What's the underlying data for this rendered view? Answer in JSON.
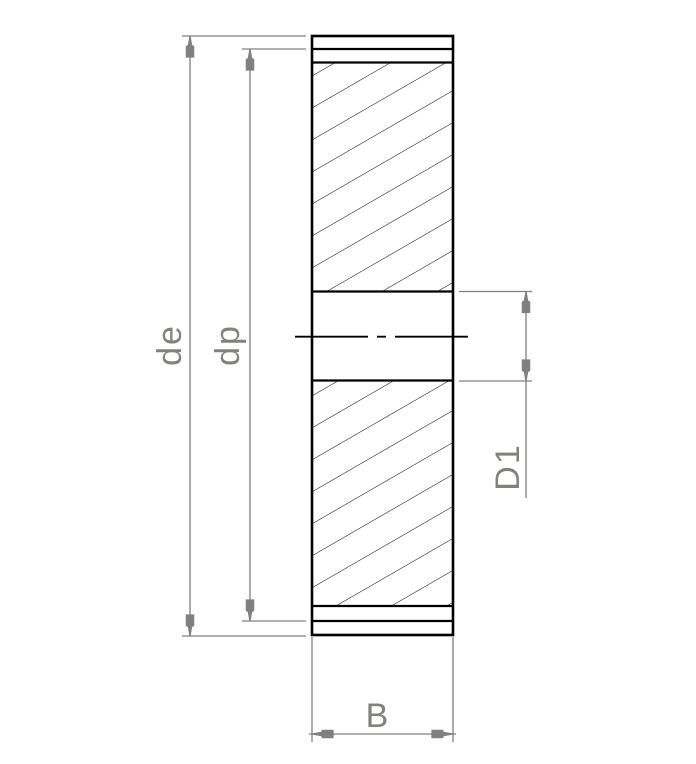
{
  "drawing": {
    "title": "gear-cross-section",
    "labels": {
      "de": "de",
      "dp": "dp",
      "d1": "D1",
      "b": "B"
    },
    "colors": {
      "outline": "#000000",
      "dimension_lines": "#808080",
      "label_text": "#82827d",
      "background": "#ffffff"
    }
  }
}
